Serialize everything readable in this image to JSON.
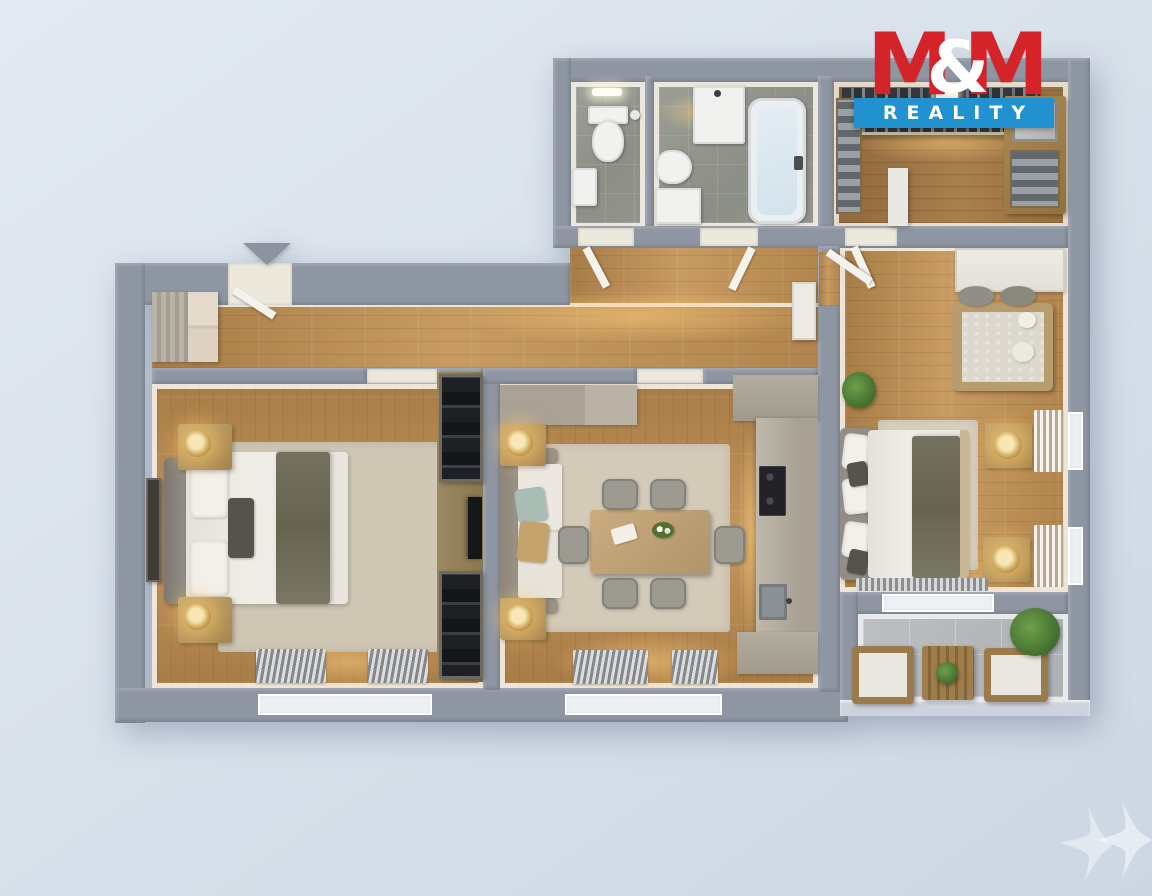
{
  "branding": {
    "logo": {
      "m_left": "M",
      "ampersand": "&",
      "m_right": "M",
      "banner": "REALITY"
    }
  },
  "colors": {
    "brand-red": "#d5232a",
    "brand-blue": "#2191d0",
    "background": "#d9e1eb",
    "wall": "#8e96a3",
    "wall-face": "#f1ece2",
    "wood": "#b5894f",
    "wood-dark": "#9c7848",
    "tile": "#92958c",
    "tile-balcony": "#b2b5b8",
    "rug": "#cfc6b4",
    "fixture-white": "#f1f1ef",
    "furniture-wood": "#b3945f",
    "wardrobe-dark": "#202227",
    "lamp-gold": "#e9cc83",
    "plant-green": "#4e7d38",
    "railing": "#ccd3dc"
  },
  "floor_plan": {
    "type": "3d-top-down-apartment-render",
    "entrance": {
      "indicator": "entrance-arrow",
      "direction": "down-into-hallway"
    },
    "rooms": [
      {
        "name": "toilet-room",
        "floor": "gray-tile",
        "items": [
          "toilet",
          "hand-basin",
          "ceiling-light"
        ]
      },
      {
        "name": "bathroom",
        "floor": "gray-tile",
        "items": [
          "washbasin-vanity",
          "bidet",
          "washing-machine",
          "bathtub",
          "wall-mixer"
        ]
      },
      {
        "name": "walk-in-closet",
        "floor": "wood",
        "items": [
          "hanging-clothes-rail",
          "left-shelves-folded-clothes",
          "right-shelf-unit",
          "mirror-cabinet",
          "white-partition"
        ]
      },
      {
        "name": "hallway",
        "floor": "wood",
        "items": [
          "entrance-door",
          "shoe-cabinet",
          "tall-white-cabinet",
          "interior-doors"
        ]
      },
      {
        "name": "bedroom-left",
        "floor": "wood",
        "items": [
          "double-bed",
          "gray-headboard",
          "dark-throw-blanket",
          "nightstand-top",
          "nightstand-bottom",
          "table-lamp-x2",
          "area-rug",
          "wall-art",
          "built-in-wardrobe-x2",
          "wall-tv",
          "radiator-x2",
          "window"
        ]
      },
      {
        "name": "living-room-kitchen",
        "floor": "wood",
        "items": [
          "sofa",
          "accent-pillows",
          "side-table-x2",
          "table-lamp-x2",
          "area-rug",
          "dining-table",
          "dining-chair-x6",
          "table-decor",
          "sideboard",
          "kitchen-counter",
          "cooktop",
          "kitchen-sink",
          "radiator-x2",
          "window"
        ]
      },
      {
        "name": "bedroom-right",
        "floor": "wood",
        "items": [
          "double-bed",
          "pillow-headboard",
          "olive-throw",
          "baby-crib",
          "plush-toys",
          "nightstand-x2",
          "table-lamp-x2",
          "area-rug",
          "potted-plant",
          "sheer-curtains",
          "windows",
          "radiator",
          "white-built-in"
        ]
      },
      {
        "name": "balcony",
        "floor": "gray-tile",
        "items": [
          "armchair-x2",
          "slatted-coffee-table",
          "small-plant",
          "potted-plant",
          "glass-railing"
        ]
      }
    ]
  },
  "watermark": {
    "shape": "two-four-point-sparkle-stars",
    "color": "#ffffff"
  }
}
